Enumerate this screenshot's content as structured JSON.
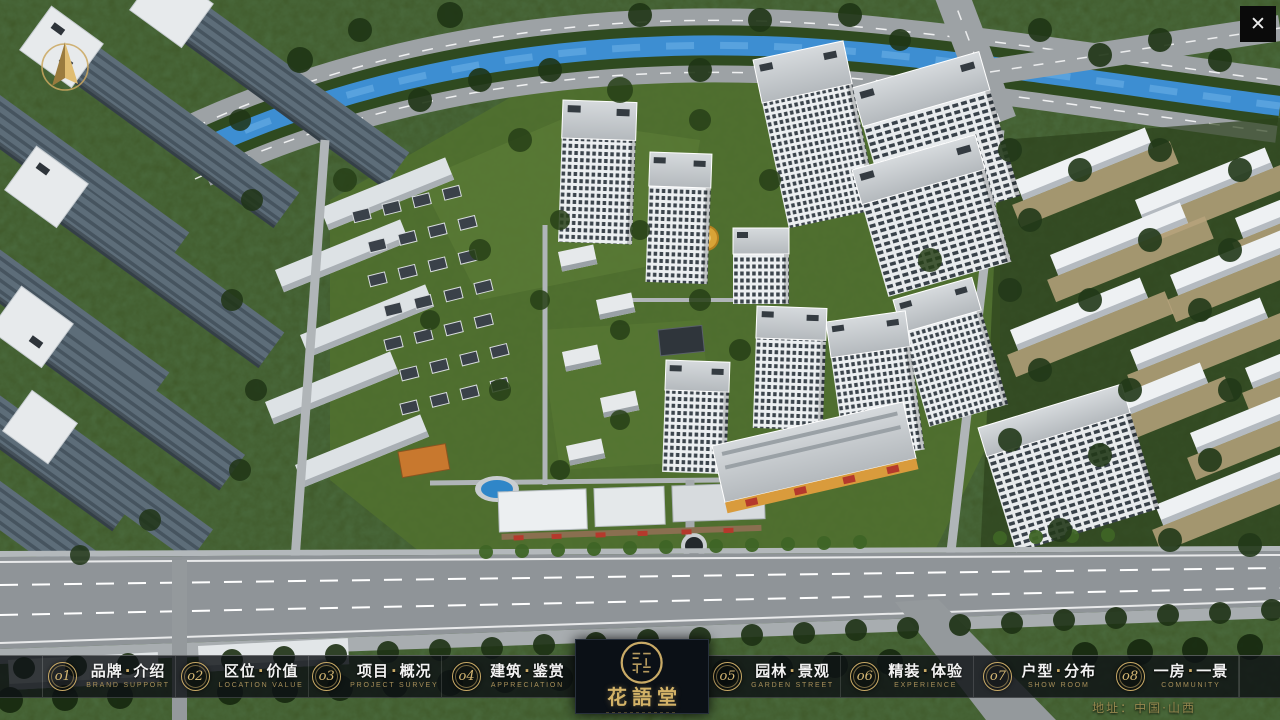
{
  "window": {
    "close_glyph": "✕"
  },
  "project": {
    "name": "花語堂"
  },
  "nav": {
    "separator": "·",
    "items": [
      {
        "num": "o1",
        "zh": [
          "品牌",
          "介绍"
        ],
        "en": "BRAND SUPPORT"
      },
      {
        "num": "o2",
        "zh": [
          "区位",
          "价值"
        ],
        "en": "LOCATION VALUE"
      },
      {
        "num": "o3",
        "zh": [
          "项目",
          "概况"
        ],
        "en": "PROJECT SURVEY"
      },
      {
        "num": "o4",
        "zh": [
          "建筑",
          "鉴赏"
        ],
        "en": "APPRECIATION"
      },
      {
        "num": "o5",
        "zh": [
          "园林",
          "景观"
        ],
        "en": "GARDEN STREET"
      },
      {
        "num": "o6",
        "zh": [
          "精装",
          "体验"
        ],
        "en": "EXPERIENCE"
      },
      {
        "num": "o7",
        "zh": [
          "户型",
          "分布"
        ],
        "en": "SHOW ROOM"
      },
      {
        "num": "o8",
        "zh": [
          "一房",
          "一景"
        ],
        "en": "COMMUNITY"
      }
    ]
  },
  "footer": {
    "address": "地址：中国·山西"
  }
}
